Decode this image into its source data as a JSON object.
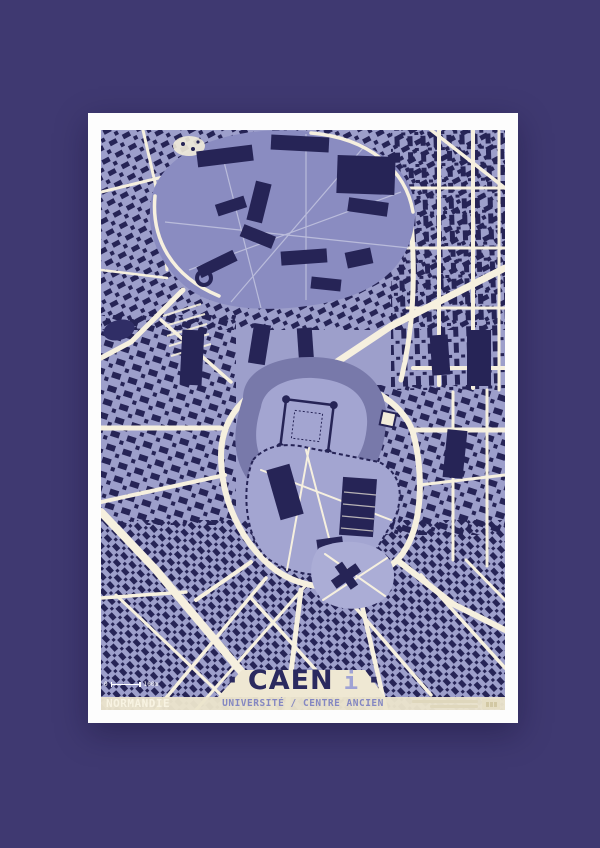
{
  "poster": {
    "title": "CAEN",
    "title_dot_left": "·",
    "title_dot_right": "·",
    "title_info_mark": "i",
    "subtitle": "UNIVERSITÉ / CENTRE ANCIEN",
    "region": "NORMANDIE",
    "scale": {
      "start": "0",
      "end": "100m"
    },
    "map_subject": "stylized street map of Caen city centre with university campus, castle and old town"
  },
  "colors": {
    "bg": "#3F3971",
    "paper": "#FDFDFD",
    "cream": "#F2ECDA",
    "street": "#F6F0DF",
    "block": "#9D9FCB",
    "campus": "#8A8CC1",
    "navy": "#262456",
    "moat": "#7879AA",
    "grounds": "#A3A5D1",
    "band": "#EBE4CC",
    "banner": "#EFE8D3",
    "title": "#2B2A5F",
    "subtitle": "#8487C2",
    "region": "#F8F3E2",
    "infomark": "#9FA2D4",
    "pond": "#302E66",
    "park": "#ABADD6"
  }
}
